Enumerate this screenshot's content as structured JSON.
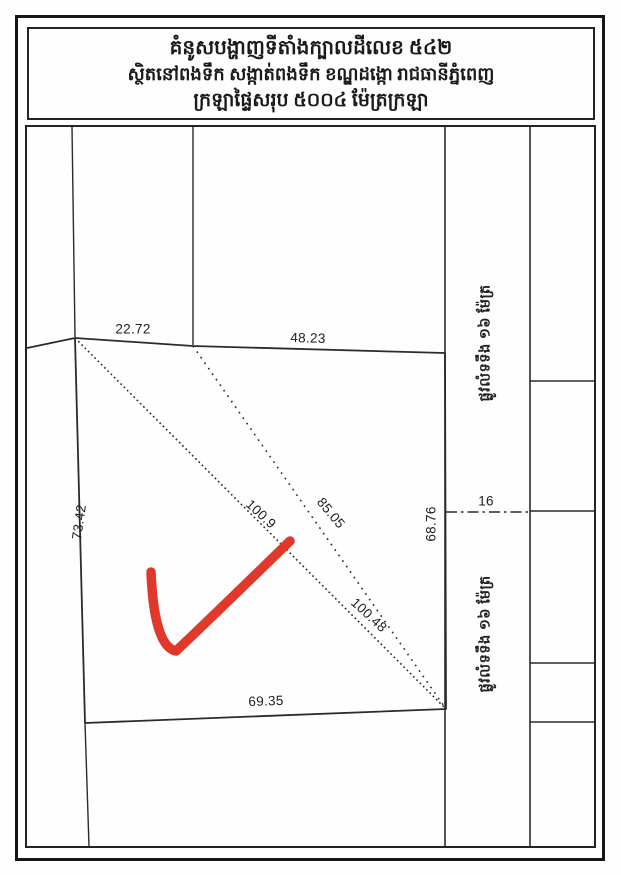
{
  "title_block": {
    "line1": "គំនូសបង្ហាញទីតាំងក្បាលដីលេខ ៥៤២",
    "line2": "ស្ថិតនៅពងទឹក សង្កាត់ពងទឹក ខណ្ឌដង្កោ រាជធានីភ្នំពេញ",
    "line3": "ក្រឡាផ្ទៃសរុប ៥០០៤ ម៉ែត្រក្រឡា"
  },
  "parcel": {
    "edge_labels": {
      "top_left_segment": "22.72",
      "top_right_segment": "48.23",
      "left": "73.42",
      "right": "68.76",
      "bottom": "69.35"
    },
    "diagonal_labels": {
      "long_upper": "100.9",
      "short": "85.05",
      "long_lower": "100.48"
    },
    "road_width": "16",
    "road_label_upper": "ផ្លូវលំទទឹង ១៦ ម៉ែត្រ",
    "road_label_lower": "ផ្លូវលំទទឹង ១៦ ម៉ែត្រ"
  },
  "colors": {
    "ink": "#2b2b2b",
    "frame": "#161616",
    "highlight_red": "#e0392b",
    "paper": "#fefefe"
  }
}
